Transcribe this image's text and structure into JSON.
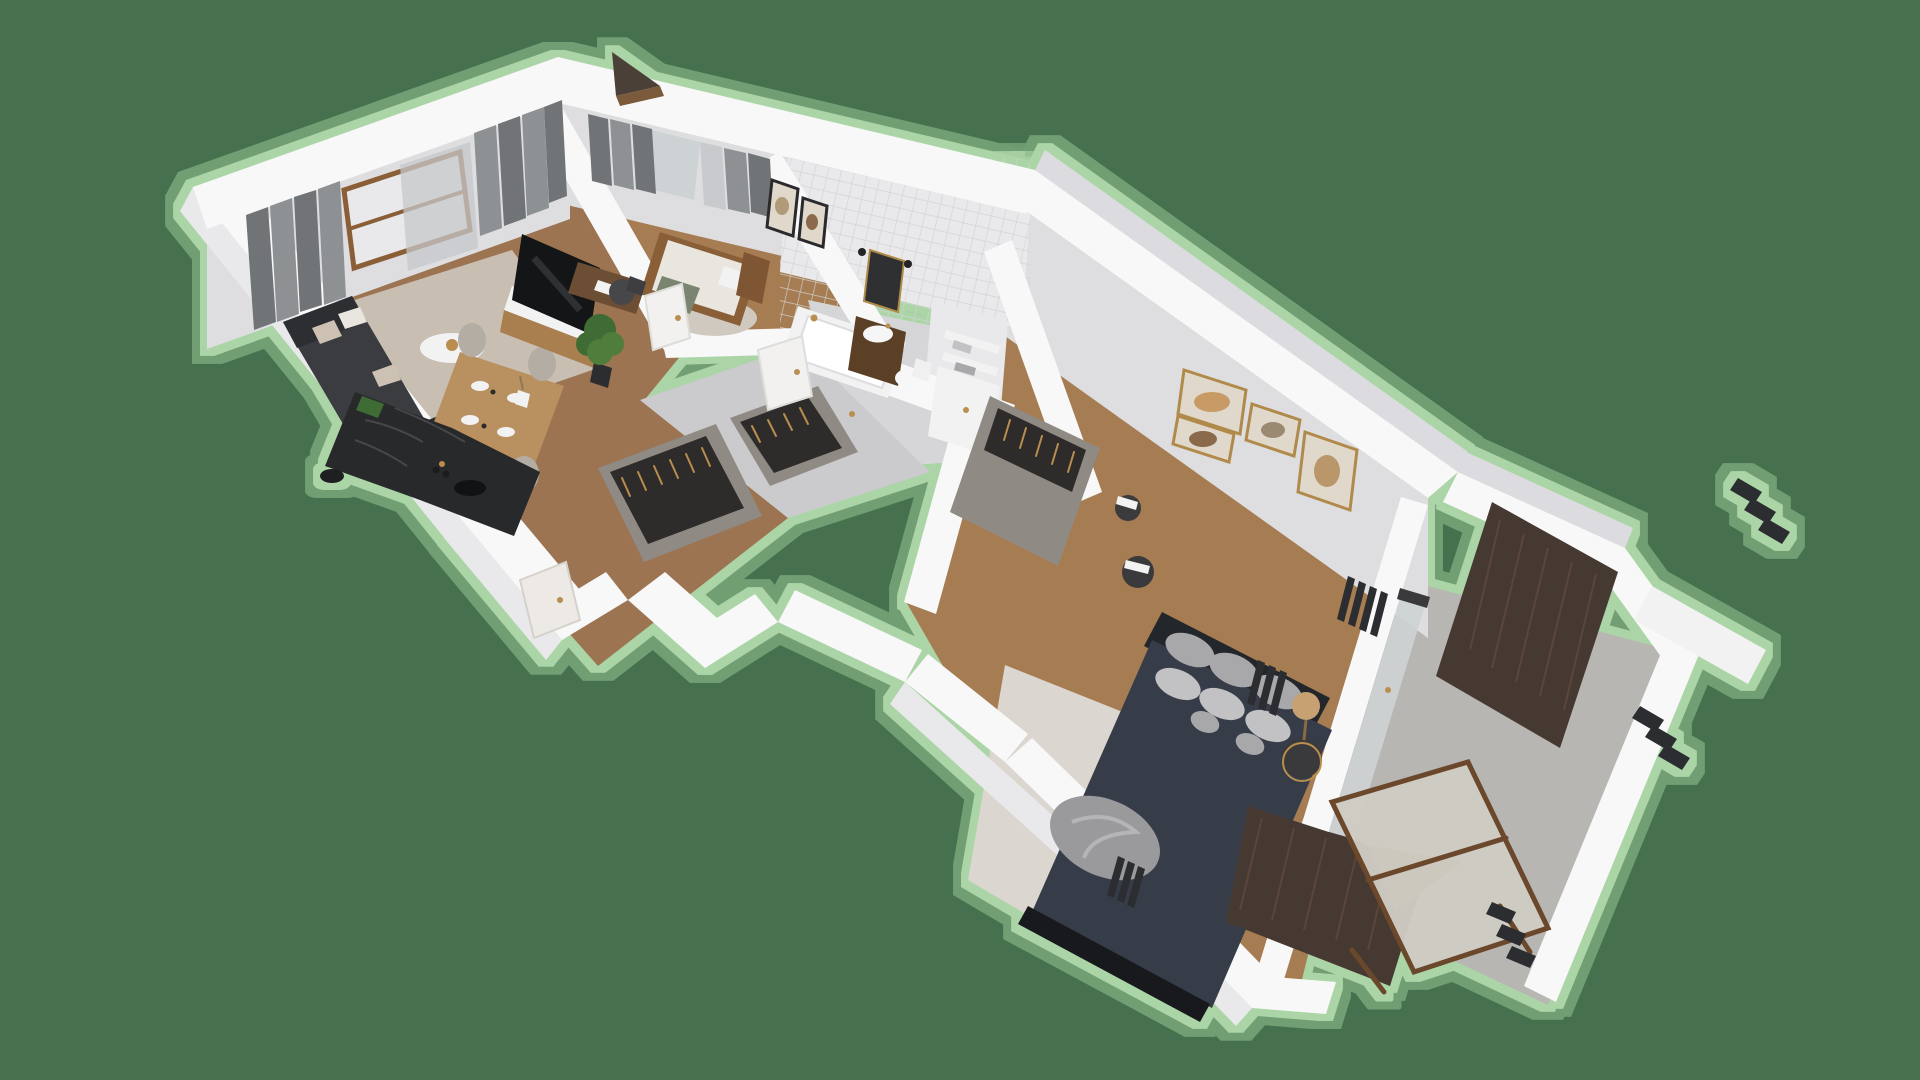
{
  "scene": {
    "kind": "isometric-3d-floorplan-render",
    "background_visible_text": "none"
  },
  "palette": {
    "bg": "#47714E",
    "haloInner": "#B7DFB0",
    "haloOuter": "#9CCB97",
    "wall": "#F8F8F9",
    "wallFace": "#E9E9EC",
    "wallFaceDark": "#DCDCE0",
    "innerFace": "#DEDEE1",
    "woodFloor": "#9C7452",
    "woodFloorLight": "#A67D52",
    "tileWall": "#E9E9EB",
    "tileLine": "#D2D2D5",
    "tileFloor": "#D6D6D8",
    "hallTile": "#CBCBCE",
    "rugLiving": "#C8BFB2",
    "rugBedroom": "#DBD6CF",
    "rugKids": "#CFC9C0",
    "curtainDark": "#717477",
    "curtainMid": "#8E9194",
    "sheer": "#C5C7C9",
    "glass": "#CDD2D4",
    "sofa": "#3A3C3F",
    "sofaDark": "#2C2E31",
    "cushionBeige": "#CDC1B4",
    "cushionWhite": "#E9E5DF",
    "marble": "#28292B",
    "marbleVein": "#45474A",
    "woodFurniture": "#A97F50",
    "woodDark": "#6B4E33",
    "woodFrameBed": "#8A5F38",
    "tableWood": "#B9905F",
    "chairLight": "#B3ADA4",
    "white": "#F2F2F3",
    "tv": "#141517",
    "navy": "#363D49",
    "navyDark": "#17191D",
    "headboard": "#23262B",
    "pillowGray": "#A8A8AB",
    "pillowLight": "#C2C2C5",
    "throwGray": "#9A9A9D",
    "gold": "#B98E4F",
    "frameGold": "#B08A4A",
    "artBeige": "#E0D9CB",
    "wardrobe": "#8F8A84",
    "clothesDark": "#2E2C2A",
    "balconyWood": "#463931",
    "balconyWoodGrain": "#5A463B",
    "concrete": "#B7B6B2",
    "deckWood": "#9A6A33",
    "plantGreen": "#3F6C34",
    "plantLight": "#4E7D3C",
    "metalDark": "#2B2D30",
    "mirror": "#2F3032",
    "vanityWood": "#5C4026",
    "loungerMesh": "#CFCCC4",
    "loungerFrame": "#6B482C"
  },
  "rooms": {
    "living": {
      "label": "Living room with open kitchen",
      "furniture": [
        "corner-sofa",
        "throw-pillows",
        "round-coffee-table",
        "dining-table",
        "dining-chairs",
        "place-settings",
        "tv-sideboard",
        "television",
        "floor-plant",
        "kitchen-island",
        "window",
        "curtains",
        "area-rug",
        "entry-door"
      ]
    },
    "kids": {
      "label": "Second bedroom with desk",
      "furniture": [
        "single-bed",
        "desk",
        "desk-chair",
        "round-rug",
        "wall-frames",
        "curtains",
        "balcony-door"
      ]
    },
    "bathroom": {
      "label": "Tiled bathroom",
      "furniture": [
        "bathtub",
        "vanity-sink",
        "mirror",
        "toilet",
        "shelves",
        "towels",
        "gold-fixtures",
        "tiled-walls"
      ]
    },
    "hallway": {
      "label": "Hallway with built-in wardrobes",
      "furniture": [
        "built-in-wardrobes",
        "hanging-clothes",
        "interior-doors"
      ]
    },
    "bedroom": {
      "label": "Master bedroom",
      "furniture": [
        "double-bed",
        "navy-bedding",
        "gray-pillows",
        "throw-blanket",
        "headboard",
        "wardrobe",
        "nightstands",
        "rattan-lamp",
        "gallery-frames",
        "radiators",
        "area-rug",
        "balcony-glass-door"
      ]
    },
    "balcony": {
      "label": "Balcony terrace",
      "furniture": [
        "wood-wall-panels",
        "concrete-floor",
        "wooden-lounger",
        "deck-platform",
        "white-railing",
        "railing-slats"
      ]
    }
  }
}
